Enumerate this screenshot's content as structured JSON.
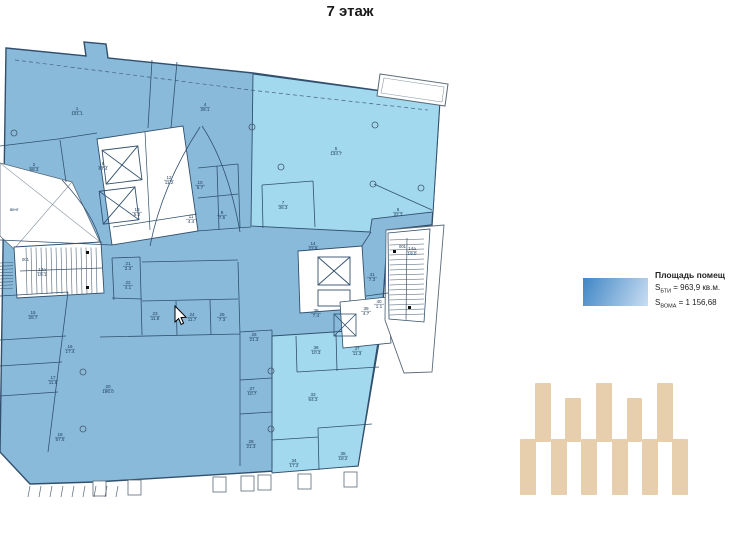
{
  "header": {
    "title": "7 этаж"
  },
  "legend": {
    "title": "Площадь помещ",
    "s1": {
      "base": "S",
      "sub": "БТИ",
      "value": " = 963,9 кв.м."
    },
    "s2": {
      "base": "S",
      "sub": "ВОМА",
      "value": " = 1 156,68"
    },
    "swatch_colors": [
      "#3f86c5",
      "#c9ddf2"
    ]
  },
  "colors": {
    "room_blue": "#8abada",
    "room_cyan": "#a2d9ef",
    "wall": "#31506e",
    "label": "#1c3a57",
    "tan": "#e7cfae"
  },
  "plan": {
    "rooms": [
      {
        "n": "1",
        "a": "101.1",
        "x": 77,
        "y": 110
      },
      {
        "n": "2",
        "a": "58.3",
        "x": 34,
        "y": 166
      },
      {
        "n": "8",
        "a": "67.4",
        "x": 103,
        "y": 165
      },
      {
        "n": "4",
        "a": "26.1",
        "x": 205,
        "y": 106
      },
      {
        "n": "5",
        "a": "134.7",
        "x": 336,
        "y": 150
      },
      {
        "n": "7",
        "a": "36.3",
        "x": 283,
        "y": 204
      },
      {
        "n": "6",
        "a": "32.7",
        "x": 398,
        "y": 211
      },
      {
        "n": "12",
        "a": "11.2",
        "x": 169,
        "y": 179
      },
      {
        "n": "10",
        "a": "5.7",
        "x": 200,
        "y": 184
      },
      {
        "n": "13",
        "a": "5.2",
        "x": 137,
        "y": 211
      },
      {
        "n": "11",
        "a": "4.4",
        "x": 191,
        "y": 218
      },
      {
        "n": "9",
        "a": "7.5",
        "x": 222,
        "y": 214
      },
      {
        "n": "14",
        "a": "22.8",
        "x": 313,
        "y": 245
      },
      {
        "n": "21",
        "a": "2.3",
        "x": 128,
        "y": 265
      },
      {
        "n": "22",
        "a": "4.1",
        "x": 128,
        "y": 284
      },
      {
        "n": "41",
        "a": "7.3",
        "x": 372,
        "y": 276
      },
      {
        "n": "15",
        "a": "28.7",
        "x": 33,
        "y": 314
      },
      {
        "n": "23",
        "a": "11.8",
        "x": 155,
        "y": 315
      },
      {
        "n": "24",
        "a": "11.7",
        "x": 192,
        "y": 316
      },
      {
        "n": "25",
        "a": "7.3",
        "x": 222,
        "y": 316
      },
      {
        "n": "38",
        "a": "7.4",
        "x": 316,
        "y": 312
      },
      {
        "n": "39",
        "a": "4.7",
        "x": 366,
        "y": 310
      },
      {
        "n": "40",
        "a": "1.1",
        "x": 379,
        "y": 303
      },
      {
        "n": "16",
        "a": "17.4",
        "x": 70,
        "y": 348
      },
      {
        "n": "17",
        "a": "11.8",
        "x": 53,
        "y": 379
      },
      {
        "n": "18",
        "a": "57.5",
        "x": 60,
        "y": 436
      },
      {
        "n": "20",
        "a": "196.0",
        "x": 108,
        "y": 388
      },
      {
        "n": "26",
        "a": "21.3",
        "x": 254,
        "y": 336
      },
      {
        "n": "27",
        "a": "10.7",
        "x": 252,
        "y": 390
      },
      {
        "n": "28",
        "a": "21.3",
        "x": 251,
        "y": 443
      },
      {
        "n": "36",
        "a": "10.3",
        "x": 316,
        "y": 349
      },
      {
        "n": "37",
        "a": "11.3",
        "x": 357,
        "y": 350
      },
      {
        "n": "33",
        "a": "64.3",
        "x": 313,
        "y": 396
      },
      {
        "n": "34",
        "a": "17.2",
        "x": 294,
        "y": 462
      },
      {
        "n": "35",
        "a": "18.2",
        "x": 343,
        "y": 455
      },
      {
        "n": "13а",
        "a": "19.1",
        "x": 42,
        "y": 271
      },
      {
        "n": "14а",
        "a": "19.0",
        "x": 412,
        "y": 250
      }
    ],
    "misc_labels": [
      {
        "t": "001",
        "x": 22,
        "y": 261
      },
      {
        "t": "001",
        "x": 399,
        "y": 248
      },
      {
        "t": "вент",
        "x": 10,
        "y": 211
      }
    ]
  },
  "decor_bars": {
    "top": [
      {
        "x": 535,
        "y": 383,
        "w": 16,
        "h": 59
      },
      {
        "x": 565,
        "y": 398,
        "w": 16,
        "h": 44
      },
      {
        "x": 596,
        "y": 383,
        "w": 16,
        "h": 59
      },
      {
        "x": 627,
        "y": 398,
        "w": 15,
        "h": 44
      },
      {
        "x": 657,
        "y": 383,
        "w": 16,
        "h": 59
      }
    ],
    "bottom": [
      {
        "x": 520,
        "y": 439,
        "w": 16,
        "h": 56
      },
      {
        "x": 551,
        "y": 439,
        "w": 16,
        "h": 56
      },
      {
        "x": 581,
        "y": 439,
        "w": 16,
        "h": 56
      },
      {
        "x": 612,
        "y": 439,
        "w": 16,
        "h": 56
      },
      {
        "x": 642,
        "y": 439,
        "w": 16,
        "h": 56
      },
      {
        "x": 672,
        "y": 439,
        "w": 16,
        "h": 56
      }
    ]
  }
}
